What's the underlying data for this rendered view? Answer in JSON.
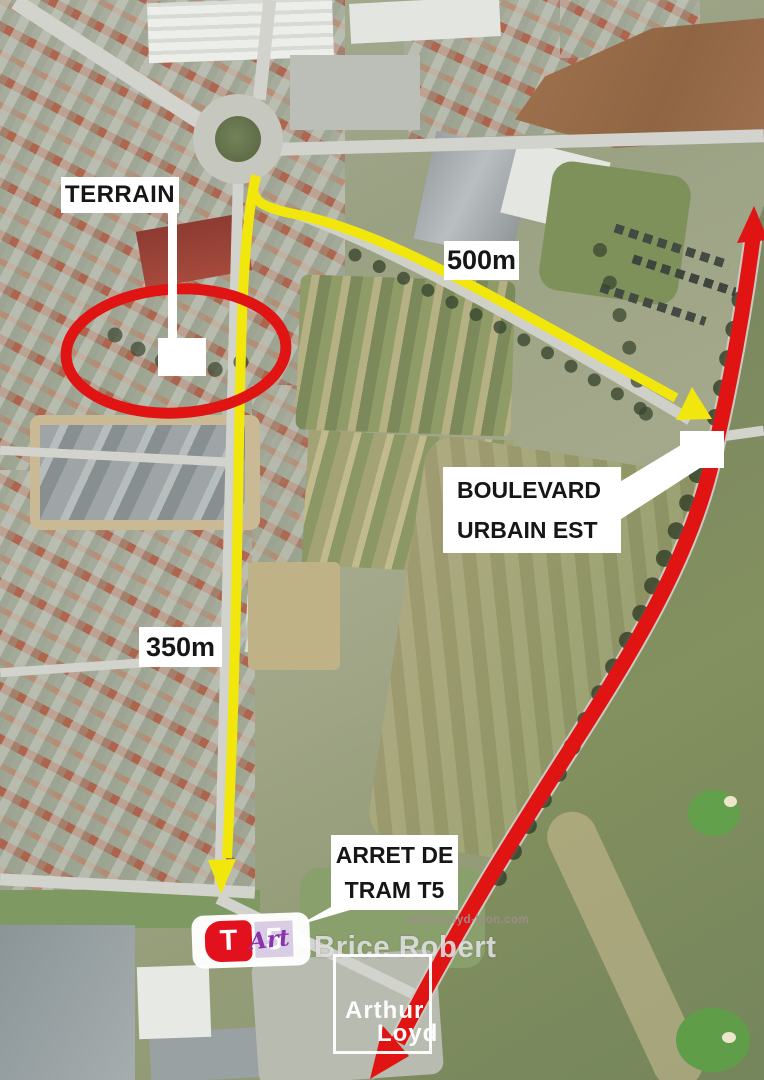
{
  "annotations": {
    "terrain_label": "TERRAIN",
    "distance_labels": {
      "route_east": "500m",
      "route_south": "350m"
    },
    "boulevard_label": {
      "line1": "BOULEVARD",
      "line2": "URBAIN EST"
    },
    "tram_stop_label": {
      "line1": "ARRET DE",
      "line2": "TRAM T5"
    }
  },
  "tram_badge": {
    "letter": "T",
    "line_number": "5",
    "script_overlay": "Art"
  },
  "watermarks": {
    "website": "arthur-loyd-lyon.com",
    "agent_name": "Brice Robert",
    "logo": {
      "line1": "Arthur",
      "line2": "Loyd"
    }
  },
  "colors": {
    "route_yellow": "#f2e70d",
    "highlight_red": "#e11414",
    "marker_white": "#ffffff",
    "tram_red": "#e2111d",
    "tram_line_lavender": "#d8cde2",
    "script_purple": "#8a33ad"
  }
}
